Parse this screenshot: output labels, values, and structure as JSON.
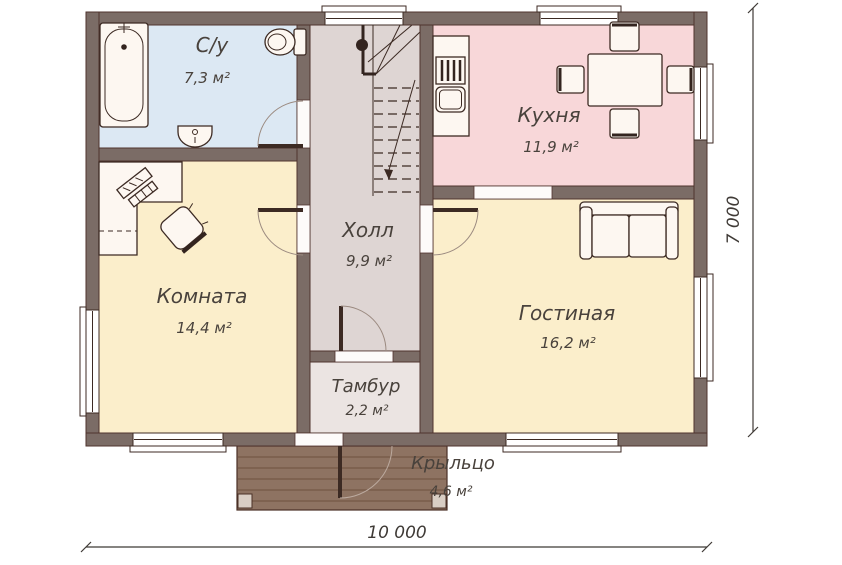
{
  "plan": {
    "rooms": [
      {
        "id": "bathroom",
        "label": "С/у",
        "area": "7,3 м²",
        "color": "#dce8f3"
      },
      {
        "id": "kitchen",
        "label": "Кухня",
        "area": "11,9 м²",
        "color": "#f8d7d9"
      },
      {
        "id": "hall",
        "label": "Холл",
        "area": "9,9 м²",
        "color": "#ded5d3"
      },
      {
        "id": "room",
        "label": "Комната",
        "area": "14,4 м²",
        "color": "#fbeecb"
      },
      {
        "id": "living",
        "label": "Гостиная",
        "area": "16,2 м²",
        "color": "#fbeecb"
      },
      {
        "id": "tambour",
        "label": "Тамбур",
        "area": "2,2 м²",
        "color": "#ebe4e2"
      },
      {
        "id": "porch",
        "label": "Крыльцо",
        "area": "4,6 м²",
        "color": "#8e7362"
      }
    ],
    "dimensions": {
      "width": "10 000",
      "height": "7 000"
    },
    "colors": {
      "wall": "#7b6c66",
      "wall_outline": "#4f332d",
      "line": "#3c2a23",
      "window_fill": "#ffffff",
      "furniture_fill": "#fdf7f1",
      "porch_plank": "#6d513f",
      "porch_post": "#d9cec4",
      "text": "#49423c",
      "dimension": "#3f3a36",
      "background": "#ffffff"
    },
    "icons": {
      "bathtub": "rounded tub with faucet and drain",
      "toilet": "bowl with cistern",
      "washbasin": "pedestal sink",
      "stove": "hob with burner grate bars",
      "kitchen-sink": "rounded basin",
      "dining-table": "table with four chairs",
      "sofa": "two-cushion sofa with armrests",
      "desk": "l-shaped corner desk",
      "office-chair": "rotated swivel chair",
      "computer": "monitor and keyboard",
      "staircase": "winder stair with newel and down arrow",
      "door": "quarter-circle swing arc",
      "window": "triple-line frame in wall"
    }
  }
}
